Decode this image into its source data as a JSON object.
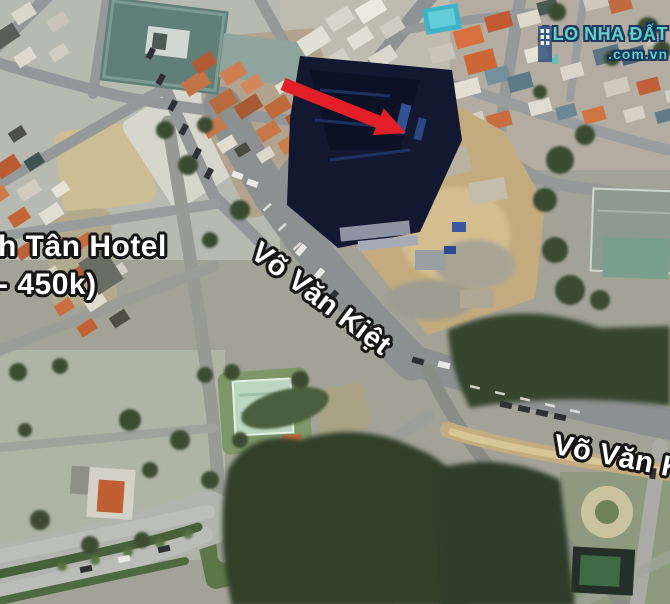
{
  "map": {
    "kind": "satellite",
    "street_labels": [
      {
        "id": "vvk-main",
        "text": "Võ Văn Kiệt"
      },
      {
        "id": "vvk-east",
        "text": "Võ Văn K"
      }
    ],
    "poi_label": {
      "line1": "h Tân Hotel",
      "line2": "- 450k)"
    }
  },
  "watermark": {
    "brand": "ALO NHA ĐẤT",
    "domain": ".com.vn",
    "icon": "building-icon",
    "brand_color": "#5ed3c8",
    "outline_color": "#14315c"
  },
  "annotation": {
    "type": "arrow",
    "color": "#e21f26"
  }
}
